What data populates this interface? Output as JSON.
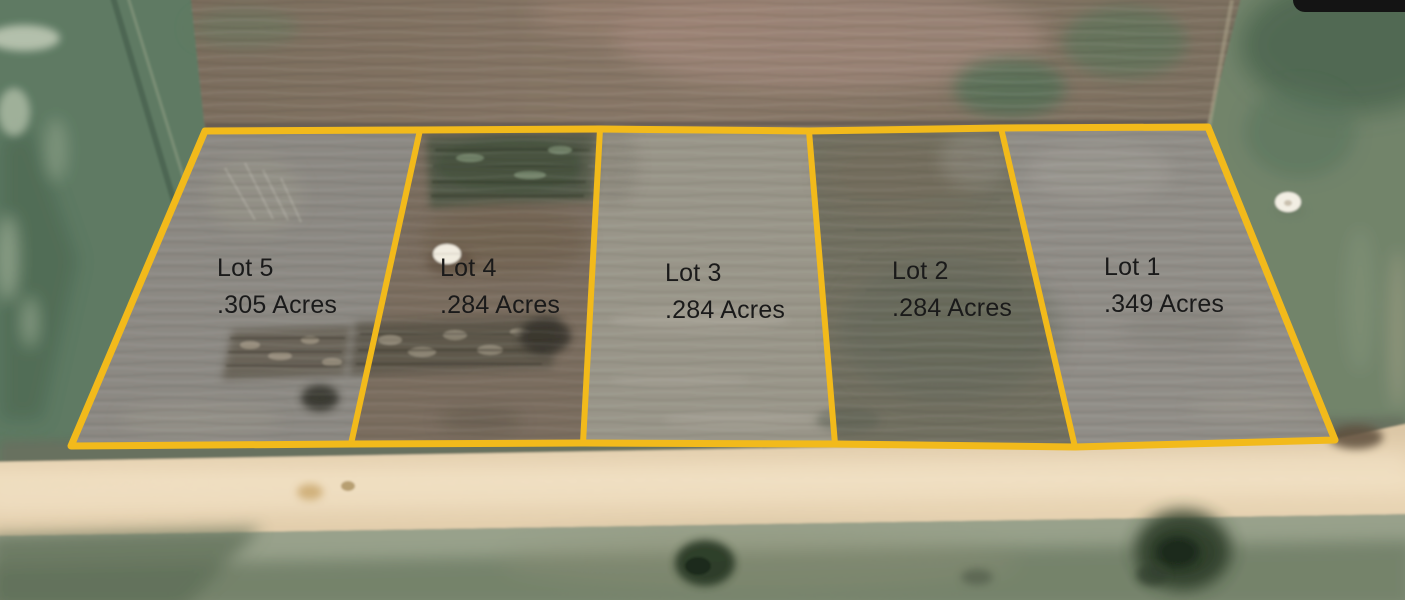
{
  "map": {
    "outline_color": "#F2BA1B",
    "label_color": "#1A1A1A",
    "lots": [
      {
        "name": "Lot 5",
        "acreage": ".305 Acres"
      },
      {
        "name": "Lot 4",
        "acreage": ".284 Acres"
      },
      {
        "name": "Lot 3",
        "acreage": ".284 Acres"
      },
      {
        "name": "Lot 2",
        "acreage": ".284 Acres"
      },
      {
        "name": "Lot 1",
        "acreage": ".349 Acres"
      }
    ]
  }
}
